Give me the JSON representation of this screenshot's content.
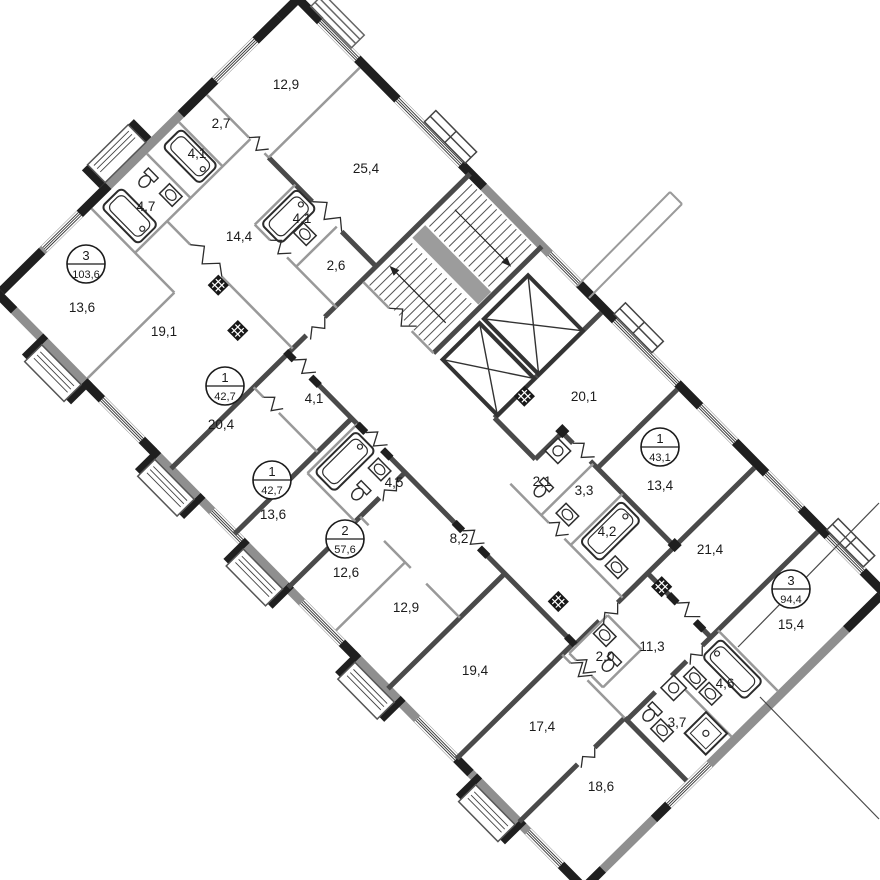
{
  "plan": {
    "type": "floor-plan",
    "background": "#ffffff",
    "colors": {
      "exterior_wall": "#8f8f8f",
      "load_bearing_wall": "#4a4a4a",
      "partition_wall": "#999999",
      "pier": "#1f1f1f",
      "text": "#1b1b1b"
    },
    "rooms": [
      {
        "label": "12,9",
        "x": 286,
        "y": 84
      },
      {
        "label": "2,7",
        "x": 221,
        "y": 123
      },
      {
        "label": "4,1",
        "x": 197,
        "y": 153
      },
      {
        "label": "4,7",
        "x": 146,
        "y": 206
      },
      {
        "label": "25,4",
        "x": 366,
        "y": 168
      },
      {
        "label": "14,4",
        "x": 239,
        "y": 236
      },
      {
        "label": "4,1",
        "x": 302,
        "y": 218
      },
      {
        "label": "2,6",
        "x": 336,
        "y": 265
      },
      {
        "label": "13,6",
        "x": 82,
        "y": 307
      },
      {
        "label": "19,1",
        "x": 164,
        "y": 331
      },
      {
        "label": "20,4",
        "x": 221,
        "y": 424
      },
      {
        "label": "4,1",
        "x": 314,
        "y": 398
      },
      {
        "label": "13,6",
        "x": 273,
        "y": 514
      },
      {
        "label": "4,5",
        "x": 394,
        "y": 482
      },
      {
        "label": "2,1",
        "x": 542,
        "y": 481
      },
      {
        "label": "3,3",
        "x": 584,
        "y": 490
      },
      {
        "label": "20,1",
        "x": 584,
        "y": 396
      },
      {
        "label": "13,4",
        "x": 660,
        "y": 485
      },
      {
        "label": "4,2",
        "x": 607,
        "y": 531
      },
      {
        "label": "21,4",
        "x": 710,
        "y": 549
      },
      {
        "label": "15,4",
        "x": 791,
        "y": 624
      },
      {
        "label": "8,2",
        "x": 459,
        "y": 538
      },
      {
        "label": "12,6",
        "x": 346,
        "y": 572
      },
      {
        "label": "12,9",
        "x": 406,
        "y": 607
      },
      {
        "label": "19,4",
        "x": 475,
        "y": 670
      },
      {
        "label": "2,0",
        "x": 605,
        "y": 656
      },
      {
        "label": "11,3",
        "x": 652,
        "y": 646
      },
      {
        "label": "4,6",
        "x": 725,
        "y": 683
      },
      {
        "label": "3,7",
        "x": 677,
        "y": 722
      },
      {
        "label": "17,4",
        "x": 542,
        "y": 726
      },
      {
        "label": "18,6",
        "x": 601,
        "y": 786
      }
    ],
    "apartments": [
      {
        "rooms_count": "3",
        "area": "103,6",
        "x": 86,
        "y": 264
      },
      {
        "rooms_count": "1",
        "area": "42,7",
        "x": 225,
        "y": 386
      },
      {
        "rooms_count": "1",
        "area": "42,7",
        "x": 272,
        "y": 480
      },
      {
        "rooms_count": "2",
        "area": "57,6",
        "x": 345,
        "y": 539
      },
      {
        "rooms_count": "1",
        "area": "43,1",
        "x": 660,
        "y": 447
      },
      {
        "rooms_count": "3",
        "area": "94,4",
        "x": 791,
        "y": 589
      }
    ],
    "leader_lines": [
      {
        "x1": 738,
        "y1": 647,
        "x2": 879,
        "y2": 503
      },
      {
        "x1": 760,
        "y1": 697,
        "x2": 879,
        "y2": 819
      }
    ],
    "balcony_edges": [
      {
        "x1": 577,
        "y1": 286,
        "x2": 670,
        "y2": 192
      },
      {
        "x1": 589,
        "y1": 298,
        "x2": 682,
        "y2": 204
      },
      {
        "x1": 670,
        "y1": 192,
        "x2": 682,
        "y2": 204
      }
    ]
  }
}
